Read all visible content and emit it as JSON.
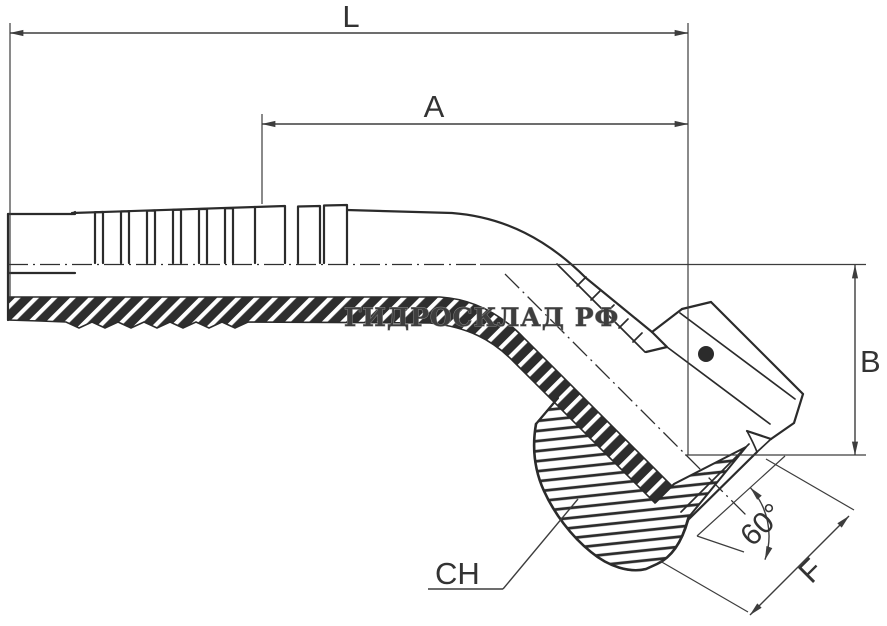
{
  "page": {
    "background": "#ffffff",
    "width": 887,
    "height": 626
  },
  "drawing": {
    "kind": "technical dimensional drawing",
    "subject": "45-degree elbow hydraulic hose fitting with barbed shank and female swivel nut, half-section view",
    "line_color": "#2b2b2b",
    "dim_color": "#3d3d3d",
    "labels": {
      "overall_length": "L",
      "cutoff_length": "A",
      "drop_height": "B",
      "thread_size": "F",
      "wrench_size": "CH",
      "seat_angle": "60°"
    },
    "watermark": {
      "text": "ГИДРОСКЛАД РФ",
      "fill": "#3e3e3e",
      "outline": "#8c8c8c"
    }
  }
}
